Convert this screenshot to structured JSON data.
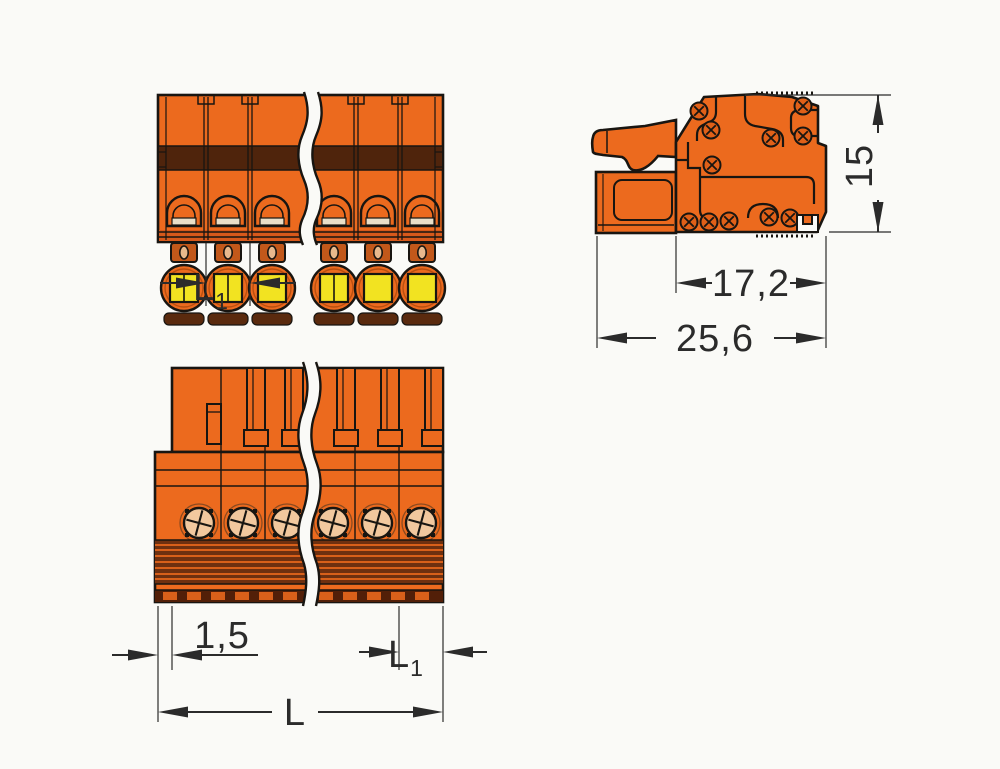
{
  "drawing": {
    "type": "technical-dimension-drawing",
    "subject": "orange-push-button-female-plug-connector",
    "views": {
      "front": "front-view-with-push-buttons",
      "side": "side-view-with-latch-lever",
      "bottom": "bottom-view-with-wire-entry-holes"
    },
    "colors": {
      "body_orange": "#ec6a1e",
      "shade_orange": "#d7591b",
      "band_brown": "#4f240c",
      "rib_brown": "#6e3010",
      "strip_brown": "#521f08",
      "button_yellow": "#f2e321",
      "hole_tan": "#f2c89e",
      "outline": "#181511",
      "dimension": "#2b2b2b",
      "background": "#fafaf7"
    }
  },
  "dim": {
    "l1_main": "L",
    "l1_sub": "1",
    "height": "15",
    "depth": "17,2",
    "total_depth": "25,6",
    "offset": "1,5",
    "length": "L"
  }
}
